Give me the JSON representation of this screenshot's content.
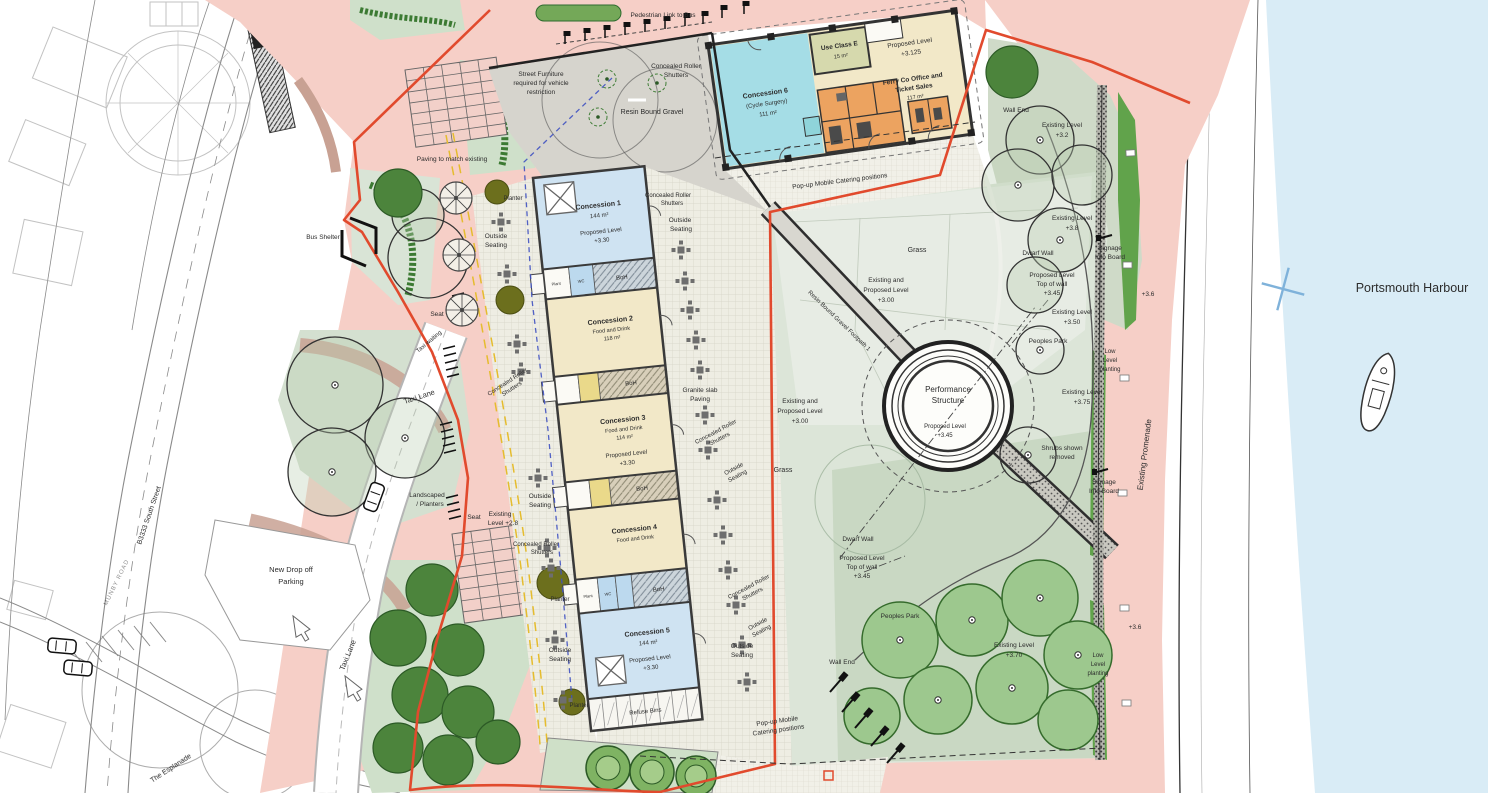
{
  "labels": {
    "harbour": "Portsmouth Harbour",
    "promenade": "Existing Promenade",
    "pedestrian_link": "Pedestrian Link to Bus",
    "street_furniture_1": "Street Furniture",
    "street_furniture_2": "required for vehicle",
    "street_furniture_3": "restriction",
    "concealed_1": "Concealed Roller",
    "concealed_2": "Shutters",
    "resin_gravel": "Resin Bound Gravel",
    "footpath": "Resin Bound Gravel Footpath 1",
    "paving_match": "Paving to match existing",
    "bus_shelter": "Bus Shelter",
    "outside_1": "Outside",
    "outside_2": "Seating",
    "planter": "Planter",
    "seat": "Seat",
    "taxi_waiting": "Taxi waiting",
    "existing_28_1": "Existing",
    "existing_28_2": "Level +2.8",
    "landscaped_1": "Landscaped",
    "landscaped_2": "/ Planters",
    "new_dropoff_1": "New Drop off",
    "new_dropoff_2": "Parking",
    "taxi_lane": "Taxi Lane",
    "b3333": "B3333 South Street",
    "munby": "MUNBY ROAD",
    "esplanade": "The Esplanade",
    "granite_1": "Granite slab",
    "granite_2": "Paving",
    "boh": "BoH",
    "wc": "WC",
    "plant": "Plant",
    "refuse": "Refuse Bins",
    "popup_line": "Pop-up Mobile Catering positions",
    "popup_1": "Pop-up Mobile",
    "popup_2": "Catering positions",
    "grass": "Grass",
    "existing_and": "Existing and",
    "proposed_level": "Proposed Level",
    "lvl_300": "+3.00",
    "lvl_330": "+3.30",
    "lvl_345": "+3.45",
    "lvl_3125": "+3.125",
    "performance_1": "Performance",
    "performance_2": "Structure",
    "peoples_park": "Peoples Park",
    "dwarf_wall": "Dwarf Wall",
    "top_of_wall": "Top of wall",
    "existing_level": "Existing Level",
    "lvl_32": "+3.2",
    "lvl_38": "+3.8",
    "lvl_350": "+3.50",
    "lvl_375": "+3.75",
    "lvl_370": "+3.70",
    "lvl_36": "+3.6",
    "wall_end": "Wall End",
    "signage_1": "Signage",
    "signage_2": "Info Board",
    "low_1": "Low",
    "low_2": "Level",
    "low_3": "planting",
    "shrubs_1": "Shrubs shown",
    "shrubs_2": "removed"
  },
  "buildings": {
    "c1": {
      "name": "Concession 1",
      "area": "144 m²"
    },
    "c2": {
      "name": "Concession 2",
      "use": "Food and Drink",
      "area": "118 m²"
    },
    "c3": {
      "name": "Concession 3",
      "use": "Food and Drink",
      "area": "114 m²"
    },
    "c4": {
      "name": "Concession 4",
      "use": "Food and Drink"
    },
    "c5": {
      "name": "Concession 5",
      "area": "144 m²"
    },
    "c6": {
      "name": "Concession 6",
      "use": "(Cycle Surgery)",
      "area": "111 m²"
    },
    "use_class_e": {
      "name": "Use Class E",
      "area": "15 m²"
    },
    "ferry": {
      "name_1": "Ferry Co Office and",
      "name_2": "Ticket Sales",
      "area": "117 m²"
    }
  },
  "colors": {
    "site_boundary": "#e14a2d",
    "paved_pink": "#f6cfc7",
    "water": "#d9ecf6",
    "park_green": "#d8e2d3",
    "concession_blue": "#cfe3f2",
    "concession_cream": "#f2e8c8",
    "concession_cyan": "#a5dde6",
    "wc_orange": "#eca360",
    "accent_green": "#61a34b"
  }
}
